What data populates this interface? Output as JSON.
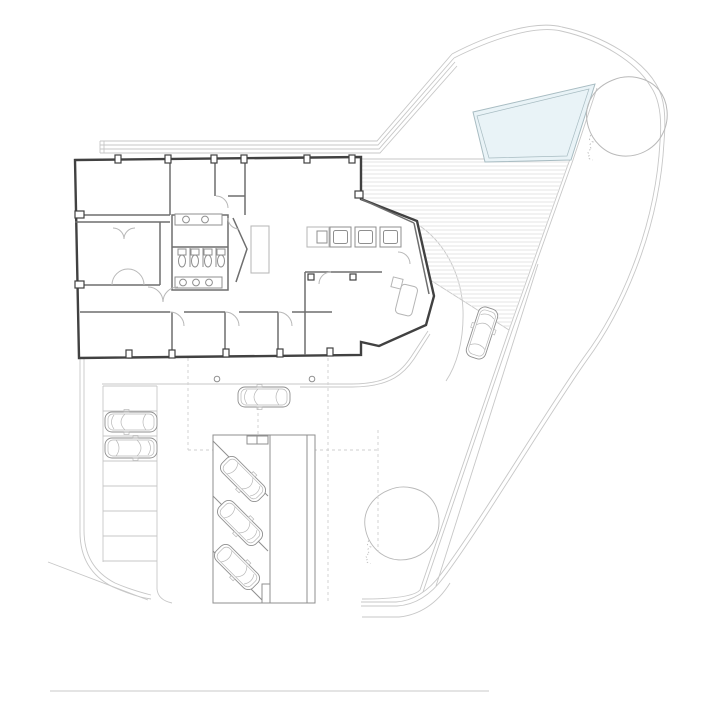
{
  "colors": {
    "background": "#ffffff",
    "site_line": "#c7c7c7",
    "wall_dark": "#414141",
    "wall_mid": "#6e6e6e",
    "fixture": "#8f8f8f",
    "furniture": "#b5b5b5",
    "door_arc": "#b8b8b8",
    "dashed_guide": "#cfcfcf",
    "deck_hatch": "#e5e5e5",
    "pool_fill": "#e9f3f7",
    "pool_stroke": "#a8bcc2",
    "tree": "#b9b9b9",
    "scale_line": "#dcdcdc"
  },
  "inventory": {
    "cars_total": 7,
    "cars_in_left_stalls": 2,
    "cars_on_entry_drive": 1,
    "cars_in_carport": 3,
    "cars_on_driveway": 1,
    "trees": 2,
    "pools": 1,
    "left_parking_rows": 7,
    "carport_angled_stalls": 3,
    "washroom_toilets": 4,
    "washroom_basins_north": 2,
    "washroom_basins_south": 3,
    "appliance_units": 3
  },
  "notes": {
    "visible_text_labels": "none"
  }
}
